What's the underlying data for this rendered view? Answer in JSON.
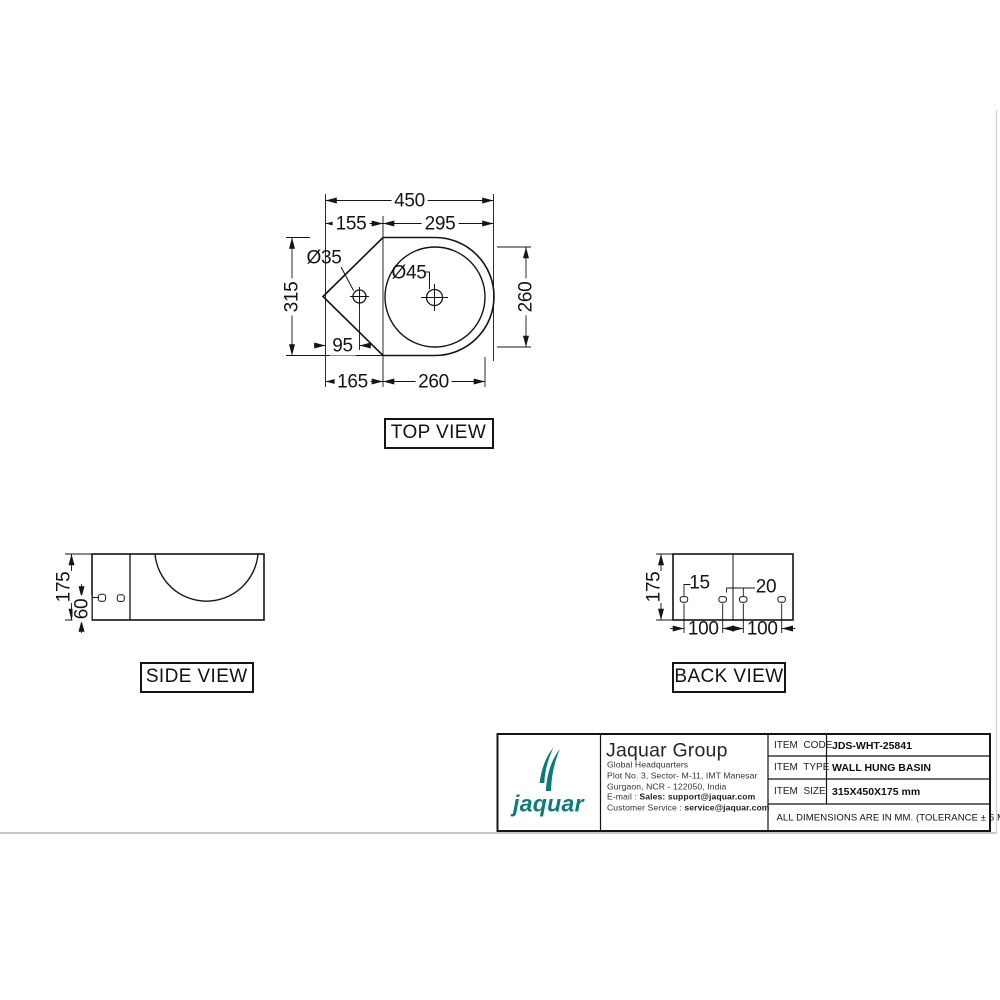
{
  "sheet": {
    "views": {
      "top": {
        "label": "TOP VIEW",
        "dims": {
          "overall_width": "450",
          "left_segment": "155",
          "right_segment": "295",
          "faucet_hole_dia": "Ø35",
          "drain_dia": "Ø45",
          "overall_depth": "315",
          "bowl_dia": "260",
          "faucet_offset": "95",
          "bottom_left": "165",
          "bottom_right": "260"
        }
      },
      "side": {
        "label": "SIDE VIEW",
        "dims": {
          "height": "175",
          "hole_height": "60"
        }
      },
      "back": {
        "label": "BACK VIEW",
        "dims": {
          "height": "175",
          "slot_left": "15",
          "slot_right": "20",
          "pitch_left": "100",
          "pitch_right": "100"
        }
      }
    },
    "title_block": {
      "brand": {
        "wordmark": "jaquar",
        "color": "#0d7c79"
      },
      "company_name": "Jaquar Group",
      "address_lines": [
        "Global Headquarters",
        "Plot No. 3, Sector- M-11, IMT Manesar",
        "Gurgaon, NCR - 122050, India"
      ],
      "email_label": "E-mail : ",
      "email_value": "Sales: support@jaquar.com",
      "service_label": "Customer Service : ",
      "service_value": "service@jaquar.com",
      "items": [
        {
          "label": "ITEM  CODE",
          "value": "JDS-WHT-25841"
        },
        {
          "label": "ITEM  TYPE",
          "value": "WALL HUNG BASIN"
        },
        {
          "label": "ITEM  SIZE",
          "value": "315X450X175 mm"
        }
      ],
      "note": "ALL DIMENSIONS ARE IN MM. (TOLERANCE ± 5 MM)"
    }
  }
}
